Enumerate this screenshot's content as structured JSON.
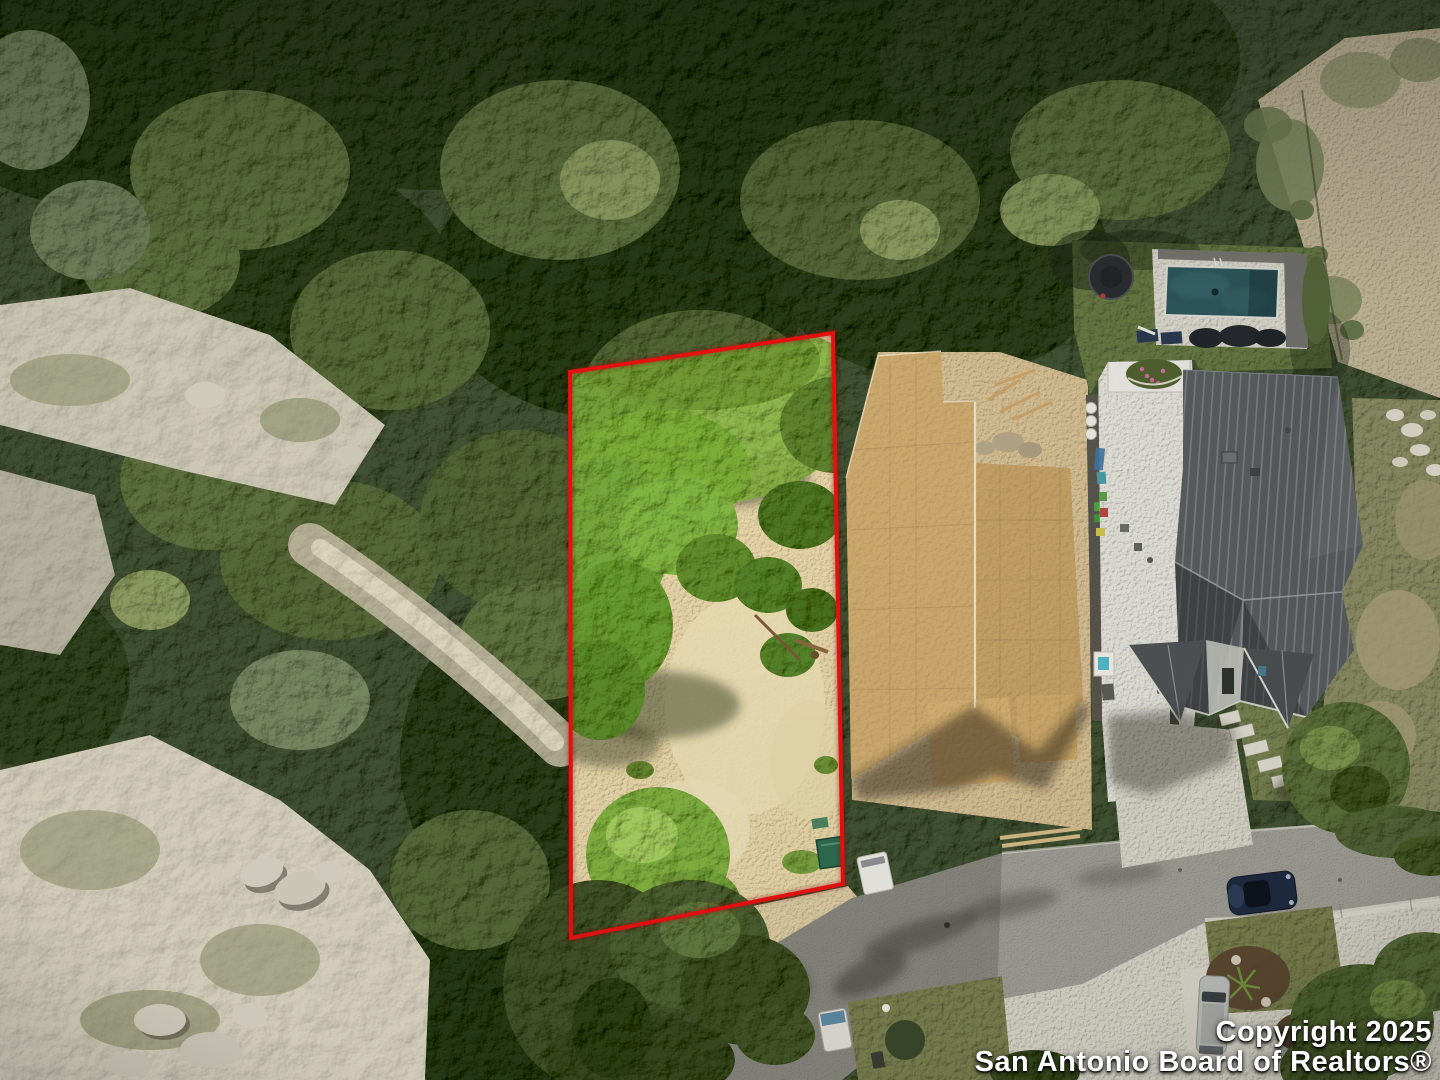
{
  "meta": {
    "width": 1440,
    "height": 1080,
    "kind": "aerial-drone-photo",
    "subject": "Vacant residential lot outlined in red next to new-construction homes, San Antonio TX"
  },
  "watermark": {
    "line1": "Copyright 2025",
    "line2": "San Antonio Board of Realtors®"
  },
  "palette": {
    "boundary_red": "#e81010",
    "canopy_dark": "#46523b",
    "canopy_bright": "#7fa148",
    "lot_sand": "#d8c79c",
    "limestone": "#c9c3b2",
    "osb_tan": "#c3a169",
    "roof_gray": "#585c5e",
    "road_gray": "#98978f",
    "concrete": "#c8c5b9",
    "pool_teal": "#2e565b",
    "lawn_green": "#5e6e3d",
    "watermark_white": "#ffffff"
  },
  "objects": [
    {
      "name": "red-lot-boundary",
      "desc": "red outline around vacant lot"
    },
    {
      "name": "osb-roof-house",
      "desc": "house under construction with bare OSB roof sheathing"
    },
    {
      "name": "metal-roof-house",
      "desc": "finished house with dark standing-seam metal roof and white patio"
    },
    {
      "name": "swimming-pool",
      "desc": "backyard pool with deck, loungers and trampoline"
    },
    {
      "name": "street",
      "desc": "asphalt street with parked navy car and silver SUV"
    },
    {
      "name": "dry-creek",
      "desc": "limestone dry creek bed with boulders"
    },
    {
      "name": "tree-canopy",
      "desc": "dense oak and juniper canopy"
    },
    {
      "name": "green-dumpster",
      "desc": "green bin at lot corner"
    },
    {
      "name": "white-van",
      "desc": "white van parked on dirt near street"
    }
  ]
}
